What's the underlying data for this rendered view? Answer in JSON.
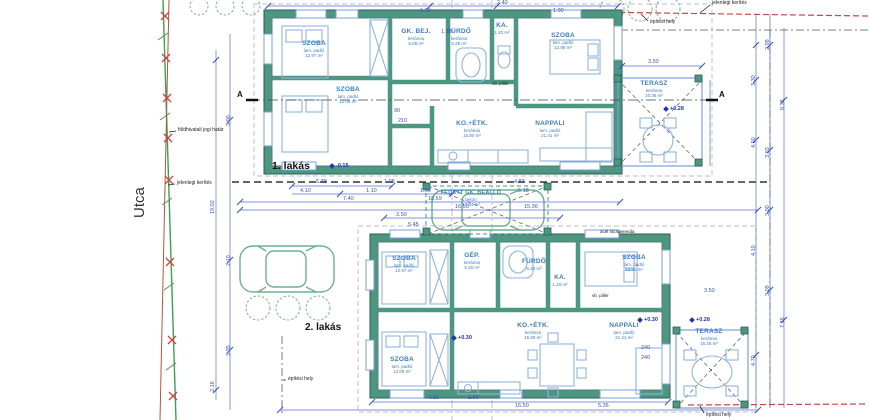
{
  "site": {
    "street": "Utca",
    "legal_boundary": "földhivatali jogi határ",
    "fence_left": "jelenlegi kerítés",
    "fence_top": "jelenlegi kerítés",
    "building_area_top": "építési hely",
    "building_area_bottom_left": "építési hely",
    "building_area_bottom_right": "építési hely",
    "section_a": "A",
    "pillar_1": "vb. pillér",
    "pillar_2": "vb. pillér",
    "beam": "acél rácsgerenda"
  },
  "house1": {
    "title": "1. lakás",
    "level": "-0.15",
    "terrace_level": "+0.28",
    "rooms": [
      {
        "name": "SZOBA",
        "finish": "lam. padló",
        "area": "12.97 m²"
      },
      {
        "name": "SZOBA",
        "finish": "lam. padló",
        "area": "12.08 m²"
      },
      {
        "name": "GK. BEJ.",
        "finish": "kerámia",
        "area": "5.08 m²"
      },
      {
        "name": "FÜRDŐ",
        "finish": "kerámia",
        "area": "5.28 m²"
      },
      {
        "name": "KA.",
        "finish": "kerámia",
        "area": "1.20 m²"
      },
      {
        "name": "SZOBA",
        "finish": "lam. padló",
        "area": "12.86 m²"
      },
      {
        "name": "KO.+ÉTK.",
        "finish": "kerámia",
        "area": "15.80 m²"
      },
      {
        "name": "NAPPALI",
        "finish": "lam. padló",
        "area": "21.41 m²"
      },
      {
        "name": "TERASZ",
        "finish": "kerámia",
        "area": "10.36 m²"
      }
    ]
  },
  "house2": {
    "title": "2. lakás",
    "living_level": "+0.30",
    "entry_level": "+0.30",
    "terrace_level": "+0.28",
    "rooms": [
      {
        "name": "SZOBA",
        "finish": "lam. padló",
        "area": "12.97 m²"
      },
      {
        "name": "GÉP.",
        "finish": "kerámia",
        "area": "5.40 m²"
      },
      {
        "name": "FÜRDŐ",
        "finish": "kerámia",
        "area": "5.28 m²"
      },
      {
        "name": "KA.",
        "finish": "kerámia",
        "area": "1.20 m²"
      },
      {
        "name": "SZOBA",
        "finish": "lam. padló",
        "area": "12.86 m²"
      },
      {
        "name": "SZOBA",
        "finish": "lam. padló",
        "area": "12.08 m²"
      },
      {
        "name": "KO.+ÉTK.",
        "finish": "kerámia",
        "area": "15.80 m²"
      },
      {
        "name": "NAPPALI",
        "finish": "lam. padló",
        "area": "21.41 m²"
      },
      {
        "name": "TERASZ",
        "finish": "kerámia",
        "area": "15.26 m²"
      }
    ]
  },
  "carport": {
    "name": "FEDETT GK. BEÁLLÓ",
    "finish": "beton",
    "area": "17.54 m²"
  },
  "dims": {
    "mid": [
      "5.38",
      "4.10",
      "1.08",
      "1.10",
      "1.50",
      "7.40",
      "18.59",
      "16.50",
      "4.83",
      "5.18",
      "15.36",
      "3.50",
      "5.45"
    ],
    "top": [
      "1.90",
      "1.38",
      "2.40",
      "1.90"
    ],
    "bottom": [
      "4.10",
      "1.50",
      "16.50",
      "5.36"
    ],
    "left": [
      "19.02",
      "3.00",
      "2.10",
      "3.35",
      "2.16"
    ],
    "right": [
      "2.98",
      "3.30",
      "8.36",
      "4.50",
      "3.03",
      "4.70",
      "3.00",
      "7.36",
      "4.10",
      "3.09"
    ],
    "misc": [
      "3.50",
      "3.50",
      "90",
      "210",
      "240",
      "240"
    ]
  },
  "colors": {
    "wall": "#4c9682",
    "wall_dark": "#2a5f52",
    "dimension": "#3a53c4",
    "room_label": "#3d7dc0",
    "boundary_green": "#3f9e4f",
    "fence_red": "#cc4444",
    "furniture": "#8fb3e0"
  }
}
